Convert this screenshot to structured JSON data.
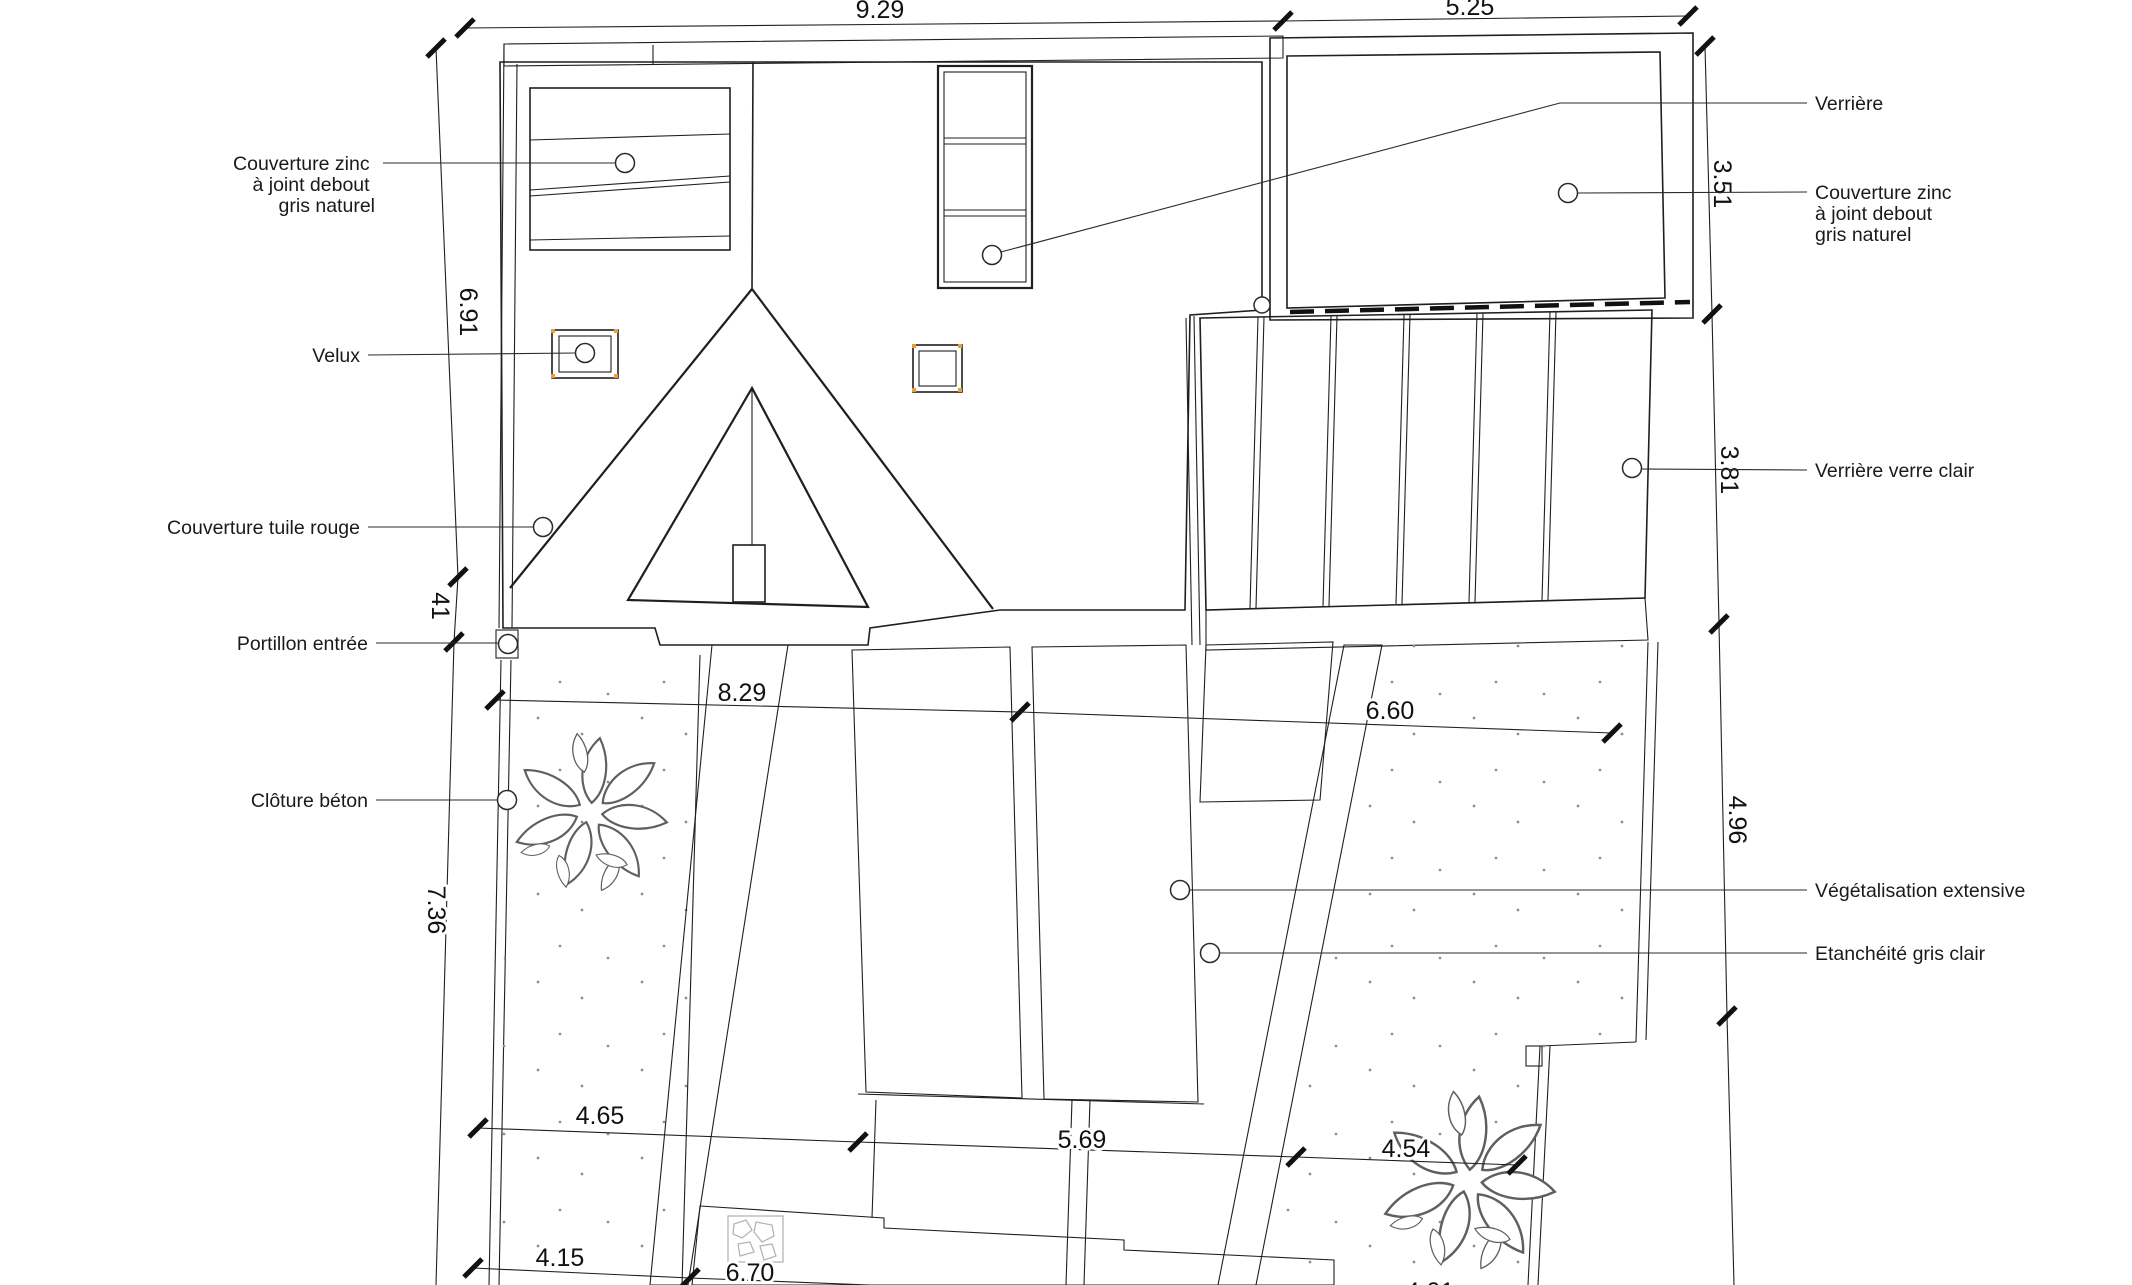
{
  "colors": {
    "ink": "#1f1f1f",
    "tile_pattern": "#7d7d7d",
    "zinc_seam": "#666666",
    "sprout": "#8a8a8a",
    "deck_stripe": "#a6a6a6",
    "dot": "#909090",
    "stone": "#b5b5b5",
    "snap_marker": "#e5a13a"
  },
  "dimensions": {
    "top": [
      {
        "value": "9.29"
      },
      {
        "value": "5.25"
      }
    ],
    "right": [
      {
        "value": "3.51"
      },
      {
        "value": "3.81"
      },
      {
        "value": "4.96"
      }
    ],
    "left": [
      {
        "value": "6.91"
      },
      {
        "value": "41"
      },
      {
        "value": "7.36"
      }
    ],
    "middle": [
      {
        "value": "8.29"
      },
      {
        "value": "6.60"
      }
    ],
    "bottom": [
      {
        "value": "4.65"
      },
      {
        "value": "5.69"
      },
      {
        "value": "4.54"
      },
      {
        "value": "4.15"
      },
      {
        "value": "6.70"
      },
      {
        "value": "4.01"
      }
    ]
  },
  "annotations": {
    "left": [
      {
        "lines": [
          "Couverture zinc",
          "à joint debout",
          "gris naturel"
        ]
      },
      {
        "lines": [
          "Velux"
        ]
      },
      {
        "lines": [
          "Couverture tuile rouge"
        ]
      },
      {
        "lines": [
          "Portillon entrée"
        ]
      },
      {
        "lines": [
          "Clôture béton"
        ]
      }
    ],
    "right": [
      {
        "lines": [
          "Verrière"
        ]
      },
      {
        "lines": [
          "Couverture zinc",
          "à joint debout",
          "gris naturel"
        ]
      },
      {
        "lines": [
          "Verrière verre clair"
        ]
      },
      {
        "lines": [
          "Végétalisation extensive"
        ]
      },
      {
        "lines": [
          "Etanchéité gris clair"
        ]
      }
    ]
  }
}
